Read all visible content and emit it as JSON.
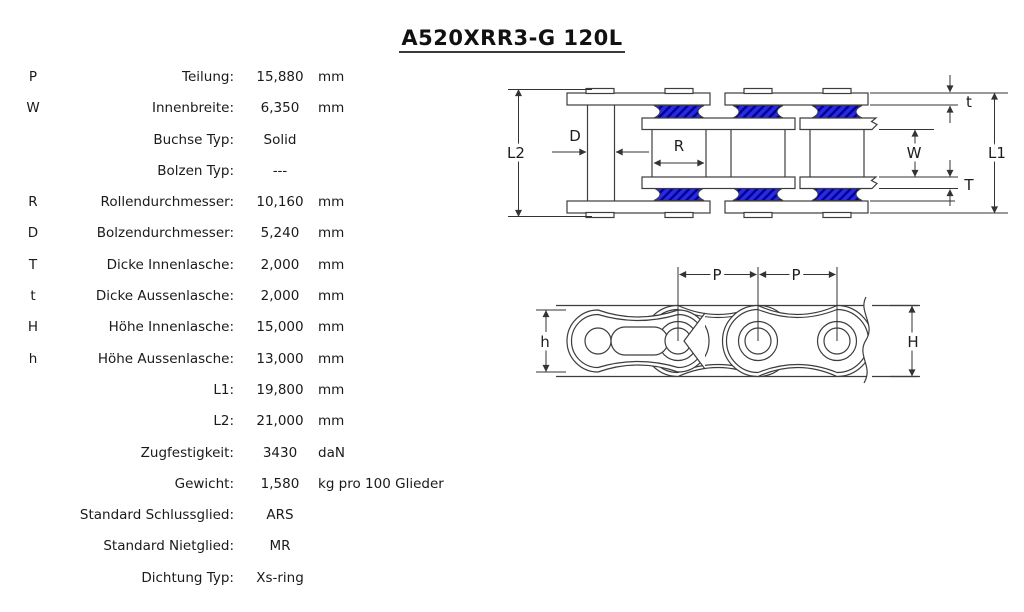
{
  "title": "A520XRR3-G 120L",
  "table": {
    "rows": [
      {
        "sym": "P",
        "label": "Teilung:",
        "value": "15,880",
        "unit": "mm"
      },
      {
        "sym": "W",
        "label": "Innenbreite:",
        "value": "6,350",
        "unit": "mm"
      },
      {
        "sym": "",
        "label": "Buchse Typ:",
        "value": "Solid",
        "unit": ""
      },
      {
        "sym": "",
        "label": "Bolzen Typ:",
        "value": "---",
        "unit": ""
      },
      {
        "sym": "R",
        "label": "Rollendurchmesser:",
        "value": "10,160",
        "unit": "mm"
      },
      {
        "sym": "D",
        "label": "Bolzendurchmesser:",
        "value": "5,240",
        "unit": "mm"
      },
      {
        "sym": "T",
        "label": "Dicke Innenlasche:",
        "value": "2,000",
        "unit": "mm"
      },
      {
        "sym": "t",
        "label": "Dicke Aussenlasche:",
        "value": "2,000",
        "unit": "mm"
      },
      {
        "sym": "H",
        "label": "Höhe Innenlasche:",
        "value": "15,000",
        "unit": "mm"
      },
      {
        "sym": "h",
        "label": "Höhe Aussenlasche:",
        "value": "13,000",
        "unit": "mm"
      },
      {
        "sym": "",
        "label": "L1:",
        "value": "19,800",
        "unit": "mm"
      },
      {
        "sym": "",
        "label": "L2:",
        "value": "21,000",
        "unit": "mm"
      },
      {
        "sym": "",
        "label": "Zugfestigkeit:",
        "value": "3430",
        "unit": "daN"
      },
      {
        "sym": "",
        "label": "Gewicht:",
        "value": "1,580",
        "unit": "kg pro 100 Glieder"
      },
      {
        "sym": "",
        "label": "Standard Schlussglied:",
        "value": "ARS",
        "unit": ""
      },
      {
        "sym": "",
        "label": "Standard Nietglied:",
        "value": "MR",
        "unit": ""
      },
      {
        "sym": "",
        "label": "Dichtung Typ:",
        "value": "Xs-ring",
        "unit": ""
      }
    ]
  },
  "diagram": {
    "labels": {
      "L2": "L2",
      "D": "D",
      "R": "R",
      "W": "W",
      "t": "t",
      "T": "T",
      "L1": "L1",
      "P": "P",
      "h": "h",
      "H": "H"
    }
  },
  "colors": {
    "seal_blue": "#2a2ae0",
    "seal_hatch": "#000095",
    "line": "#3d3d3d",
    "text": "#1a1a1a"
  }
}
